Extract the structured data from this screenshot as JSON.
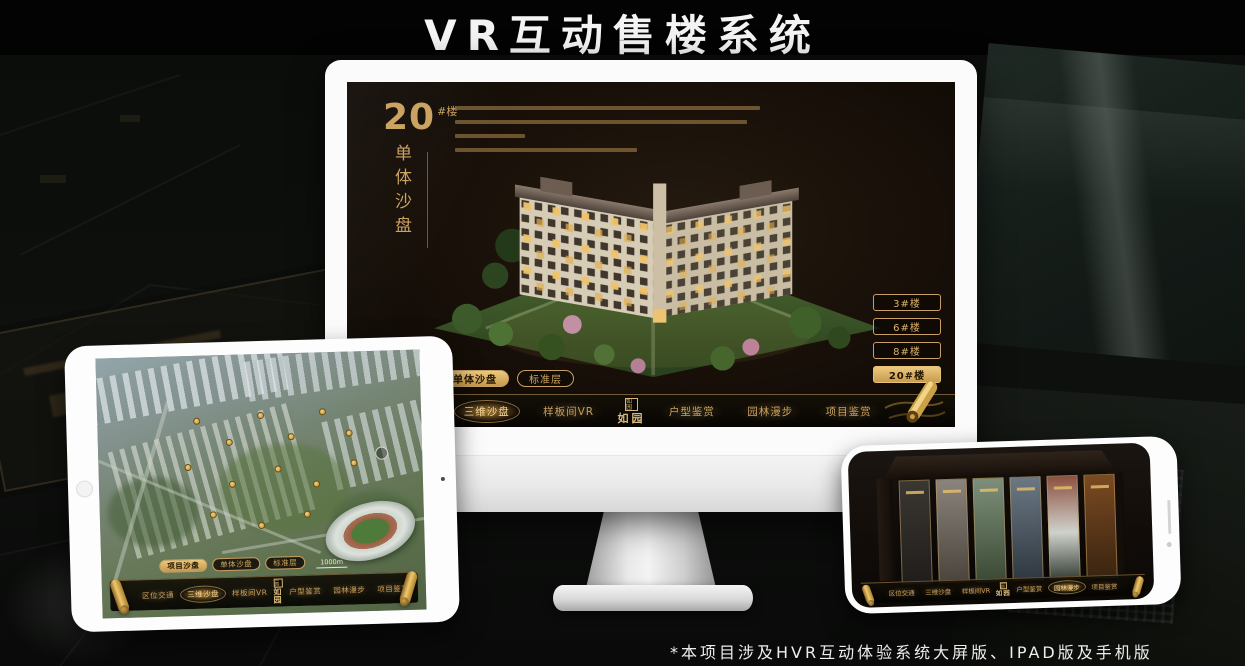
{
  "page": {
    "title": "VR互动售楼系统",
    "footnote": "*本项目涉及HVR互动体验系统大屏版、IPAD版及手机版"
  },
  "colors": {
    "gold": "#c9a063",
    "gold_bright": "#ecc87d",
    "screen_dark": "#170f08",
    "frame_white": "#fbfbfb"
  },
  "monitor": {
    "headline": {
      "number": "20",
      "suffix": "#楼",
      "vertical": "单体沙盘"
    },
    "floor_buttons": [
      {
        "label": "3#楼",
        "active": false
      },
      {
        "label": "6#楼",
        "active": false
      },
      {
        "label": "8#楼",
        "active": false
      },
      {
        "label": "20#楼",
        "active": true
      }
    ],
    "tabs": [
      {
        "label": "项目沙盘",
        "active": false
      },
      {
        "label": "单体沙盘",
        "active": true
      },
      {
        "label": "标准层",
        "active": false
      }
    ],
    "nav": {
      "logo": "如园",
      "seal": "如园",
      "scroll_icon": "gold-scroll",
      "items": [
        {
          "label": "区位交通",
          "active": false
        },
        {
          "label": "三维沙盘",
          "active": true
        },
        {
          "label": "样板间VR",
          "active": false
        },
        {
          "label": "户型鉴赏",
          "active": false
        },
        {
          "label": "园林漫步",
          "active": false
        },
        {
          "label": "项目鉴赏",
          "active": false
        }
      ]
    }
  },
  "tablet": {
    "scale_label": "1000m",
    "tabs": [
      {
        "label": "项目沙盘",
        "active": true
      },
      {
        "label": "单体沙盘",
        "active": false
      },
      {
        "label": "标准层",
        "active": false
      }
    ],
    "nav": {
      "logo": "如园",
      "seal": "如园",
      "items": [
        {
          "label": "区位交通",
          "active": false
        },
        {
          "label": "三维沙盘",
          "active": true
        },
        {
          "label": "样板间VR",
          "active": false
        },
        {
          "label": "户型鉴赏",
          "active": false
        },
        {
          "label": "园林漫步",
          "active": false
        },
        {
          "label": "项目鉴赏",
          "active": false
        }
      ]
    }
  },
  "phone": {
    "nav": {
      "logo": "如园",
      "seal": "如园",
      "items": [
        {
          "label": "区位交通",
          "active": false
        },
        {
          "label": "三维沙盘",
          "active": false
        },
        {
          "label": "样板间VR",
          "active": false
        },
        {
          "label": "户型鉴赏",
          "active": false
        },
        {
          "label": "园林漫步",
          "active": true
        },
        {
          "label": "项目鉴赏",
          "active": false
        }
      ]
    }
  }
}
